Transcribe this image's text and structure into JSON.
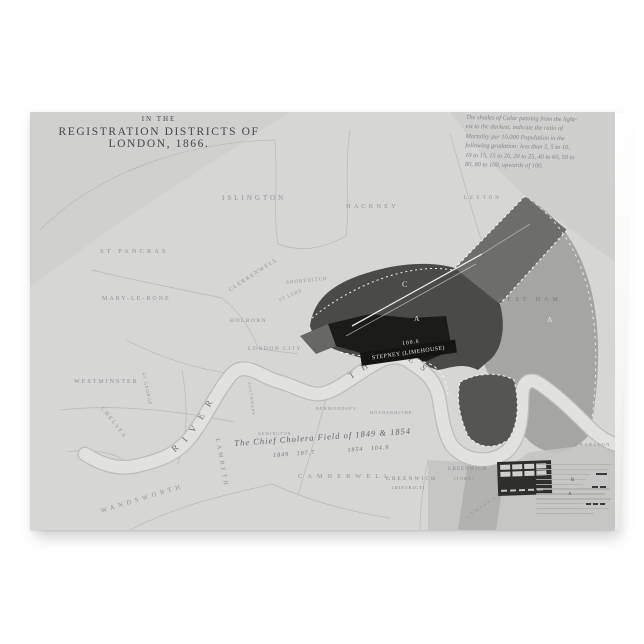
{
  "page": {
    "background": "#ffffff"
  },
  "card": {
    "title": {
      "line1": "IN THE",
      "line2": "REGISTRATION DISTRICTS OF LONDON, 1866."
    },
    "legend_note": {
      "lines": [
        "The shades of Color passing from the light-",
        "est to the darkest, indicate the ratio of",
        "Mortality per 10,000 Population in the",
        "following gradation: less than 5, 5 to 10,",
        "10 to 15, 15 to 20, 20 to 25, 40 to 60, 50 to",
        "80, 80 to 100, upwards of 100."
      ]
    },
    "river_label": {
      "river": "RIVER",
      "thames": "THAMES"
    },
    "cholera_note": {
      "line1": "The Chief Cholera Field of 1849 & 1854",
      "line2": "1849   107.7             1854   104.9"
    },
    "stepney": {
      "value": "100.6",
      "label": "STEPNEY (LIMEHOUSE)"
    },
    "markers": {
      "c": "C",
      "a_east_end": "A",
      "a_west_ham": "A"
    },
    "key_text": {
      "b": "B",
      "a": "A"
    },
    "map_labels": [
      {
        "id": "islington",
        "text": "ISLINGTON"
      },
      {
        "id": "hackney",
        "text": "HACKNEY"
      },
      {
        "id": "leyton",
        "text": "LEYTON"
      },
      {
        "id": "st-pancras",
        "text": "ST PANCRAS"
      },
      {
        "id": "marylebone",
        "text": "MARY-LE-BONE"
      },
      {
        "id": "clerkenwell",
        "text": "CLERKENWELL"
      },
      {
        "id": "st-luke",
        "text": "ST LUKE"
      },
      {
        "id": "holborn",
        "text": "HOLBORN"
      },
      {
        "id": "shoreditch",
        "text": "SHOREDITCH"
      },
      {
        "id": "london-city",
        "text": "LONDON CITY"
      },
      {
        "id": "westminster",
        "text": "WESTMINSTER"
      },
      {
        "id": "chelsea",
        "text": "CHELSEA"
      },
      {
        "id": "st-george",
        "text": "ST GEORGE"
      },
      {
        "id": "southwark",
        "text": "SOUTHWARK"
      },
      {
        "id": "bermondsey",
        "text": "BERMONDSEY"
      },
      {
        "id": "rotherhithe",
        "text": "ROTHERHITHE"
      },
      {
        "id": "newington",
        "text": "NEWINGTON"
      },
      {
        "id": "lambeth",
        "text": "LAMBETH"
      },
      {
        "id": "wandsworth",
        "text": "WANDSWORTH"
      },
      {
        "id": "camberwell",
        "text": "CAMBERWELL"
      },
      {
        "id": "greenwich-district",
        "text": "GREENWICH"
      },
      {
        "id": "greenwich-district2",
        "text": "(DISTRICT)"
      },
      {
        "id": "greenwich-town",
        "text": "GREENWICH"
      },
      {
        "id": "greenwich-town2",
        "text": "(TOWN)"
      },
      {
        "id": "west-ham",
        "text": "WEST HAM"
      },
      {
        "id": "charlton",
        "text": "CHARLTON"
      },
      {
        "id": "lewisham",
        "text": "LEWISHAM"
      }
    ]
  },
  "colors": {
    "paper": "#d6d6d4",
    "paper_outside": "#cfcfcd",
    "district_dark": "#4a4a48",
    "district_black": "#1b1b19",
    "district_medium": "#a5a5a3",
    "band_dark": "#6d6d6b",
    "river_fill": "#e1e1df",
    "river_edge": "#bcbcba",
    "boundary_line": "#b5b5b3",
    "label_gray": "#94949a",
    "title_ink": "#46464c",
    "key_background": "#2e2e2c"
  }
}
